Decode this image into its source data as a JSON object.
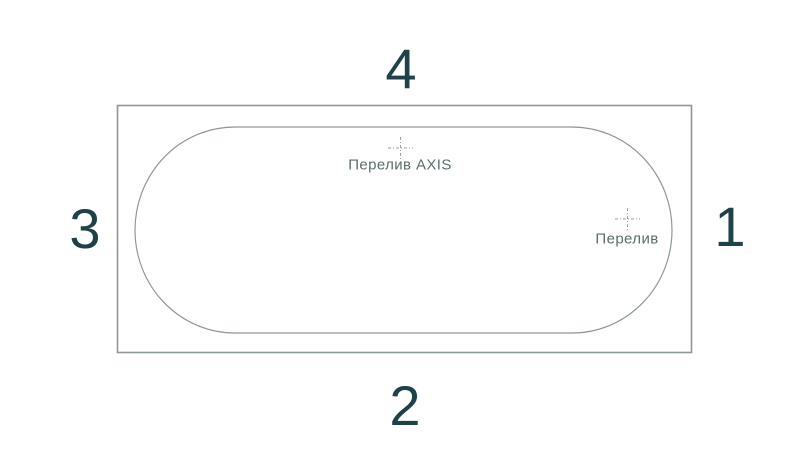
{
  "numbers": {
    "top": "4",
    "bottom": "2",
    "left": "3",
    "right": "1"
  },
  "markers": {
    "axis_overflow": {
      "label": "Перелив AXIS"
    },
    "overflow": {
      "label": "Перелив"
    }
  },
  "colors": {
    "outline": "#8d9997",
    "center_mark": "#96a09e",
    "number_text": "#1f424a",
    "label_text": "#5d6d6d",
    "background": "#ffffff"
  }
}
